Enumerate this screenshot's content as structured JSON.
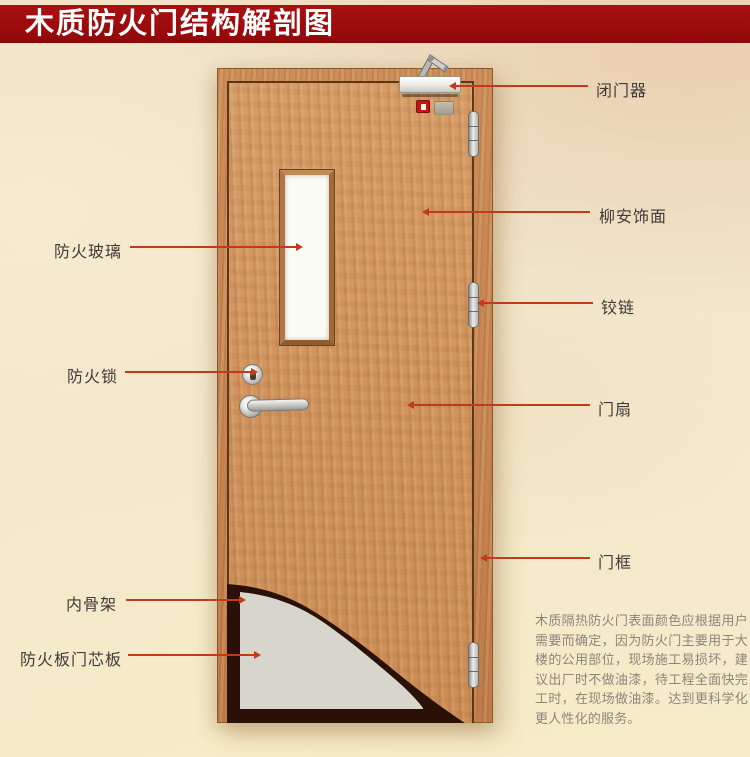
{
  "header": {
    "title": "木质防火门结构解剖图"
  },
  "annotations": {
    "right": [
      {
        "id": "door-closer",
        "text": "闭门器"
      },
      {
        "id": "lauan-veneer",
        "text": "柳安饰面"
      },
      {
        "id": "hinge",
        "text": "铰链"
      },
      {
        "id": "door-leaf",
        "text": "门扇"
      },
      {
        "id": "door-frame",
        "text": "门框"
      }
    ],
    "left": [
      {
        "id": "fire-glass",
        "text": "防火玻璃"
      },
      {
        "id": "fire-lock",
        "text": "防火锁"
      },
      {
        "id": "inner-skeleton",
        "text": "内骨架"
      },
      {
        "id": "fire-board-core",
        "text": "防火板门芯板"
      }
    ]
  },
  "description": "木质隔热防火门表面颜色应根据用户需要而确定，因为防火门主要用于大楼的公用部位，现场施工易损坏，建议出厂时不做油漆，待工程全面快完工时，在现场做油漆。达到更科学化更人性化的服务。",
  "colors": {
    "banner": "#9c0b0c",
    "leader_line": "#c13a1c",
    "label_text": "#3e3b38",
    "door_wood": "#d2945e",
    "frame_wood": "#c58452",
    "glass": "#fbfbf5",
    "core_panel": "#d8d6cc",
    "skeleton_dark": "#2a1006",
    "background": "#f3e8cc"
  }
}
